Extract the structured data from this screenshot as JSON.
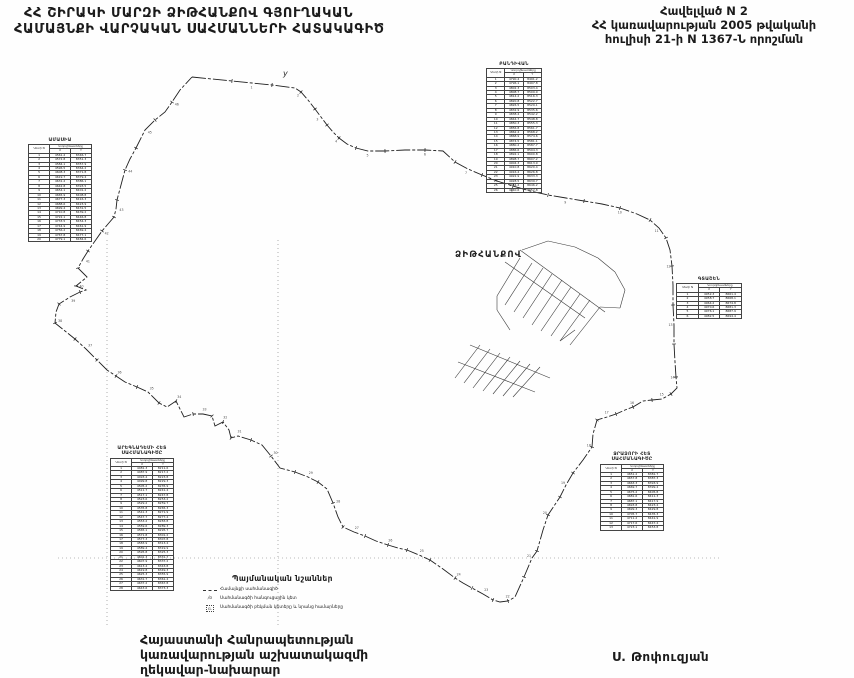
{
  "header": {
    "title_line1": "ՀՀ ՇԻՐԱԿԻ ՄԱՐԶԻ ՁԻԹՀԱՆՔՈՎ ԳՅՈՒՂԱԿԱՆ",
    "title_line2": "ՀԱՄԱՅՆՔԻ ՎԱՐՉԱԿԱՆ ՍԱՀՄԱՆՆԵՐԻ ՀԱՏԱԿԱԳԻԾ"
  },
  "annex": {
    "line1": "Հավելված N 2",
    "line2": "ՀՀ կառավարության 2005 թվականի",
    "line3": "հուլիսի 21-ի N 1367-Ն որոշման"
  },
  "map": {
    "village_label": "ՁԻԹՀԱՆՔՈՎ",
    "village_label_pos": [
      455,
      257
    ],
    "flag_mark": {
      "label": "y",
      "x": 283,
      "y": 76
    },
    "ink": "#1f1f1f",
    "grid": {
      "verticals": [
        107,
        278
      ],
      "v_from": 240,
      "v_to": 628,
      "horizontals": [
        558
      ],
      "h_from": 58,
      "h_to": 720
    },
    "boundary_points": [
      [
        192,
        77
      ],
      [
        212,
        79
      ],
      [
        232,
        81
      ],
      [
        252,
        83
      ],
      [
        272,
        85
      ],
      [
        295,
        88
      ],
      [
        301,
        92
      ],
      [
        308,
        100
      ],
      [
        315,
        109
      ],
      [
        321,
        117
      ],
      [
        327,
        125
      ],
      [
        333,
        132
      ],
      [
        339,
        138
      ],
      [
        347,
        144
      ],
      [
        356,
        148
      ],
      [
        368,
        151
      ],
      [
        385,
        151
      ],
      [
        405,
        150
      ],
      [
        425,
        150
      ],
      [
        443,
        151
      ],
      [
        455,
        162
      ],
      [
        468,
        169
      ],
      [
        482,
        175
      ],
      [
        497,
        181
      ],
      [
        513,
        186
      ],
      [
        530,
        191
      ],
      [
        548,
        195
      ],
      [
        566,
        198
      ],
      [
        584,
        201
      ],
      [
        602,
        204
      ],
      [
        620,
        208
      ],
      [
        637,
        214
      ],
      [
        650,
        220
      ],
      [
        659,
        228
      ],
      [
        666,
        238
      ],
      [
        670,
        250
      ],
      [
        672,
        266
      ],
      [
        673,
        285
      ],
      [
        673,
        305
      ],
      [
        674,
        325
      ],
      [
        674,
        344
      ],
      [
        675,
        362
      ],
      [
        676,
        377
      ],
      [
        677,
        388
      ],
      [
        671,
        394
      ],
      [
        662,
        399
      ],
      [
        652,
        400
      ],
      [
        643,
        401
      ],
      [
        633,
        407
      ],
      [
        625,
        410
      ],
      [
        616,
        414
      ],
      [
        607,
        417
      ],
      [
        597,
        420
      ],
      [
        593,
        434
      ],
      [
        592,
        447
      ],
      [
        583,
        460
      ],
      [
        573,
        473
      ],
      [
        566,
        485
      ],
      [
        560,
        497
      ],
      [
        554,
        506
      ],
      [
        548,
        515
      ],
      [
        543,
        530
      ],
      [
        537,
        551
      ],
      [
        532,
        558
      ],
      [
        524,
        577
      ],
      [
        515,
        597
      ],
      [
        508,
        601
      ],
      [
        500,
        602
      ],
      [
        493,
        600
      ],
      [
        483,
        594
      ],
      [
        472,
        588
      ],
      [
        463,
        583
      ],
      [
        455,
        578
      ],
      [
        443,
        569
      ],
      [
        430,
        560
      ],
      [
        419,
        555
      ],
      [
        407,
        550
      ],
      [
        398,
        548
      ],
      [
        388,
        545
      ],
      [
        376,
        541
      ],
      [
        365,
        536
      ],
      [
        354,
        532
      ],
      [
        343,
        527
      ],
      [
        338,
        517
      ],
      [
        333,
        503
      ],
      [
        327,
        489
      ],
      [
        318,
        482
      ],
      [
        308,
        477
      ],
      [
        295,
        472
      ],
      [
        280,
        468
      ],
      [
        271,
        456
      ],
      [
        262,
        445
      ],
      [
        251,
        440
      ],
      [
        238,
        436
      ],
      [
        231,
        438
      ],
      [
        229,
        430
      ],
      [
        223,
        422
      ],
      [
        215,
        426
      ],
      [
        212,
        416
      ],
      [
        203,
        414
      ],
      [
        193,
        414
      ],
      [
        184,
        417
      ],
      [
        176,
        401
      ],
      [
        167,
        407
      ],
      [
        159,
        403
      ],
      [
        148,
        392
      ],
      [
        137,
        387
      ],
      [
        125,
        382
      ],
      [
        116,
        376
      ],
      [
        107,
        370
      ],
      [
        97,
        360
      ],
      [
        86,
        349
      ],
      [
        75,
        339
      ],
      [
        65,
        331
      ],
      [
        55,
        323
      ],
      [
        56,
        312
      ],
      [
        59,
        304
      ],
      [
        70,
        297
      ],
      [
        80,
        292
      ],
      [
        86,
        290
      ],
      [
        76,
        286
      ],
      [
        87,
        277
      ],
      [
        78,
        268
      ],
      [
        83,
        259
      ],
      [
        88,
        251
      ],
      [
        95,
        241
      ],
      [
        102,
        231
      ],
      [
        108,
        224
      ],
      [
        114,
        217
      ],
      [
        116,
        209
      ],
      [
        117,
        200
      ],
      [
        121,
        185
      ],
      [
        125,
        170
      ],
      [
        130,
        159
      ],
      [
        136,
        148
      ],
      [
        145,
        130
      ],
      [
        155,
        120
      ],
      [
        165,
        112
      ],
      [
        172,
        102
      ],
      [
        180,
        90
      ],
      [
        192,
        77
      ]
    ],
    "cluster_segments": [
      [
        497,
        296,
        520,
        258
      ],
      [
        505,
        305,
        532,
        263
      ],
      [
        514,
        312,
        543,
        268
      ],
      [
        523,
        318,
        552,
        274
      ],
      [
        532,
        325,
        562,
        280
      ],
      [
        541,
        331,
        571,
        287
      ],
      [
        551,
        336,
        580,
        294
      ],
      [
        560,
        341,
        590,
        300
      ],
      [
        570,
        345,
        600,
        307
      ],
      [
        505,
        262,
        585,
        318
      ],
      [
        520,
        250,
        605,
        312
      ],
      [
        522,
        250,
        548,
        241
      ],
      [
        548,
        241,
        575,
        247
      ],
      [
        575,
        247,
        598,
        258
      ],
      [
        598,
        258,
        615,
        272
      ],
      [
        615,
        272,
        625,
        290
      ],
      [
        625,
        290,
        620,
        308
      ],
      [
        600,
        307,
        620,
        308
      ],
      [
        497,
        296,
        497,
        310
      ],
      [
        497,
        310,
        510,
        330
      ],
      [
        455,
        378,
        480,
        345
      ],
      [
        464,
        383,
        490,
        349
      ],
      [
        473,
        388,
        500,
        353
      ],
      [
        483,
        391,
        510,
        357
      ],
      [
        493,
        394,
        520,
        361
      ],
      [
        503,
        396,
        530,
        364
      ],
      [
        513,
        397,
        540,
        367
      ],
      [
        458,
        362,
        535,
        392
      ],
      [
        470,
        345,
        550,
        378
      ],
      [
        560,
        341,
        575,
        330
      ]
    ]
  },
  "tables": {
    "col_n": "Կետի N",
    "col_coords": "Կոորդինատները",
    "col_x": "X",
    "col_y": "Y",
    "topLeft": {
      "title": "ԱՄԱՍԻԱ",
      "rows": [
        [
          "1",
          "4561.2",
          "8346.7"
        ],
        [
          "2",
          "4572.8",
          "8351.3"
        ],
        [
          "3",
          "4584.1",
          "8357.9"
        ],
        [
          "4",
          "4596.5",
          "8364.2"
        ],
        [
          "5",
          "4608.3",
          "8371.8"
        ],
        [
          "6",
          "4619.7",
          "8379.4"
        ],
        [
          "7",
          "4631.2",
          "8386.1"
        ],
        [
          "8",
          "4642.8",
          "8393.5"
        ],
        [
          "9",
          "4654.1",
          "8401.2"
        ],
        [
          "10",
          "4665.9",
          "8408.8"
        ],
        [
          "11",
          "4677.3",
          "8416.3"
        ],
        [
          "12",
          "4688.6",
          "8423.9"
        ],
        [
          "13",
          "4699.4",
          "8431.5"
        ],
        [
          "14",
          "4710.8",
          "8439.2"
        ],
        [
          "15",
          "4722.1",
          "8446.8"
        ],
        [
          "16",
          "4733.5",
          "8454.3"
        ],
        [
          "17",
          "4744.9",
          "8461.9"
        ],
        [
          "18",
          "4756.2",
          "8469.4"
        ],
        [
          "19",
          "4767.8",
          "8477.1"
        ],
        [
          "20",
          "4779.1",
          "8484.6"
        ]
      ]
    },
    "topCenter": {
      "title": "ԲԱՆԴԻՎԱՆ",
      "rows": [
        [
          "1",
          "4790.4",
          "8491.2"
        ],
        [
          "2",
          "4796.1",
          "8497.8"
        ],
        [
          "3",
          "4802.3",
          "8503.4"
        ],
        [
          "4",
          "4808.7",
          "8509.9"
        ],
        [
          "5",
          "4814.2",
          "8516.3"
        ],
        [
          "6",
          "4820.8",
          "8522.7"
        ],
        [
          "7",
          "4826.5",
          "8529.1"
        ],
        [
          "8",
          "4832.9",
          "8535.6"
        ],
        [
          "9",
          "4838.4",
          "8542.2"
        ],
        [
          "10",
          "4844.7",
          "8548.8"
        ],
        [
          "11",
          "4850.3",
          "8555.3"
        ],
        [
          "12",
          "4856.8",
          "8561.7"
        ],
        [
          "13",
          "4862.4",
          "8568.2"
        ],
        [
          "14",
          "4868.9",
          "8574.6"
        ],
        [
          "15",
          "4874.5",
          "8581.1"
        ],
        [
          "16",
          "4880.2",
          "8587.7"
        ],
        [
          "17",
          "4886.6",
          "8594.3"
        ],
        [
          "18",
          "4892.1",
          "8600.8"
        ],
        [
          "19",
          "4898.7",
          "8607.2"
        ],
        [
          "20",
          "4904.3",
          "8613.9"
        ],
        [
          "21",
          "4910.8",
          "8620.4"
        ],
        [
          "22",
          "4916.4",
          "8626.8"
        ],
        [
          "23",
          "4922.9",
          "8633.3"
        ],
        [
          "24",
          "4928.5",
          "8639.7"
        ],
        [
          "25",
          "4934.2",
          "8646.2"
        ],
        [
          "26",
          "4940.6",
          "8652.8"
        ]
      ]
    },
    "right": {
      "title": "ԳՏԱՇԵՆ",
      "rows": [
        [
          "1",
          "4952.3",
          "8661.4"
        ],
        [
          "2",
          "4958.7",
          "8668.1"
        ],
        [
          "3",
          "4964.2",
          "8674.8"
        ],
        [
          "4",
          "4970.6",
          "8681.3"
        ],
        [
          "5",
          "4976.1",
          "8687.9"
        ],
        [
          "6",
          "4982.5",
          "8694.4"
        ]
      ]
    },
    "bottomLeft": {
      "title": "ԱՐԵԳՆԱԴԵՄԻ ՀԵՏ\nՍԱՀՄԱՆԱԳԻԾԸ",
      "rows": [
        [
          "1",
          "4481.3",
          "8211.6"
        ],
        [
          "2",
          "4487.9",
          "8217.2"
        ],
        [
          "3",
          "4493.4",
          "8223.8"
        ],
        [
          "4",
          "4499.8",
          "8229.3"
        ],
        [
          "5",
          "4505.2",
          "8235.9"
        ],
        [
          "6",
          "4511.7",
          "8241.4"
        ],
        [
          "7",
          "4517.1",
          "8247.8"
        ],
        [
          "8",
          "4523.6",
          "8253.2"
        ],
        [
          "9",
          "4529.2",
          "8259.7"
        ],
        [
          "10",
          "4535.8",
          "8265.3"
        ],
        [
          "11",
          "4541.3",
          "8271.9"
        ],
        [
          "12",
          "4547.7",
          "8277.4"
        ],
        [
          "13",
          "4553.2",
          "8283.8"
        ],
        [
          "14",
          "4559.6",
          "8289.3"
        ],
        [
          "15",
          "4565.1",
          "8295.7"
        ],
        [
          "16",
          "4571.8",
          "8301.2"
        ],
        [
          "17",
          "4577.3",
          "8307.8"
        ],
        [
          "18",
          "4583.9",
          "8313.4"
        ],
        [
          "19",
          "4589.4",
          "8319.9"
        ],
        [
          "20",
          "4595.8",
          "8325.3"
        ],
        [
          "21",
          "4601.3",
          "8331.7"
        ],
        [
          "22",
          "4607.9",
          "8337.2"
        ],
        [
          "23",
          "4613.4",
          "8343.8"
        ],
        [
          "24",
          "4619.8",
          "8349.3"
        ],
        [
          "25",
          "4625.3",
          "8355.9"
        ],
        [
          "26",
          "4631.7",
          "8361.4"
        ],
        [
          "27",
          "4637.2",
          "8367.8"
        ],
        [
          "28",
          "4643.6",
          "8373.3"
        ]
      ]
    },
    "bottomRight": {
      "title": "ՋՐԱՁՈՐԻ ՀԵՏ\nՍԱՀՄԱՆԱԳԻԾԸ",
      "rows": [
        [
          "1",
          "4651.2",
          "8381.7"
        ],
        [
          "2",
          "4657.8",
          "8387.3"
        ],
        [
          "3",
          "4663.3",
          "8393.9"
        ],
        [
          "4",
          "4669.7",
          "8399.4"
        ],
        [
          "5",
          "4675.2",
          "8405.8"
        ],
        [
          "6",
          "4681.6",
          "8411.3"
        ],
        [
          "7",
          "4687.1",
          "8417.9"
        ],
        [
          "8",
          "4693.8",
          "8423.4"
        ],
        [
          "9",
          "4699.3",
          "8429.8"
        ],
        [
          "10",
          "4705.7",
          "8435.3"
        ],
        [
          "11",
          "4711.2",
          "8441.9"
        ],
        [
          "12",
          "4717.6",
          "8447.4"
        ],
        [
          "13",
          "4723.1",
          "8453.8"
        ]
      ]
    }
  },
  "legend": {
    "heading": "Պայմանական նշաններ",
    "items": [
      {
        "symbol": "boundary-line-symbol",
        "label": "Համայնքի սահմանագիծ"
      },
      {
        "symbol": "node-point-symbol",
        "label": "Սահմանագծի հանգուցային կետ"
      },
      {
        "symbol": "break-point-symbol",
        "label": "Սահմանագծի բեկման կետերը և նրանց համարները"
      }
    ]
  },
  "signature": {
    "line1": "Հայաստանի Հանրապետության",
    "line2": "կառավարության աշխատակազմի",
    "line3": "ղեկավար-նախարար",
    "name": "Ս. Թոփուզյան"
  }
}
